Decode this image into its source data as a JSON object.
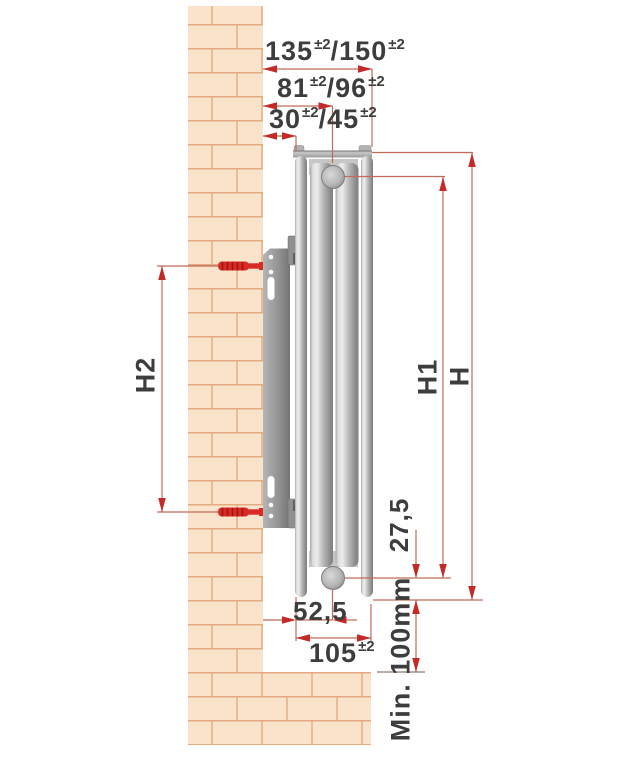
{
  "diagram": {
    "description": "Radiator side-view wall mounting dimension diagram",
    "top_dimensions": [
      {
        "value1": "135",
        "tol1": "±2",
        "sep": "/",
        "value2": "150",
        "tol2": "±2"
      },
      {
        "value1": "81",
        "tol1": "±2",
        "sep": "/",
        "value2": "96",
        "tol2": "±2"
      },
      {
        "value1": "30",
        "tol1": "±2",
        "sep": "/",
        "value2": "45",
        "tol2": "±2"
      }
    ],
    "bottom_dimensions": {
      "half_depth": "52,5",
      "depth": {
        "value": "105",
        "tol": "±2"
      }
    },
    "side_dimensions": {
      "pipe_offset": "27,5",
      "height_total": "H",
      "height_pipes": "H1",
      "bracket_spacing": "H2",
      "floor_clearance": "Min. 100mm"
    },
    "colors": {
      "dimension_arrow_red": "#c42a28",
      "dimension_line_red": "#c06a58",
      "label_text_gray": "#3d3d3d",
      "brick_fill": "#fbe3cb",
      "brick_mortar": "#e2ab80",
      "metal_light": "#ececec",
      "metal_dark": "#7e7e7e",
      "screw_red": "#d92b26"
    }
  }
}
